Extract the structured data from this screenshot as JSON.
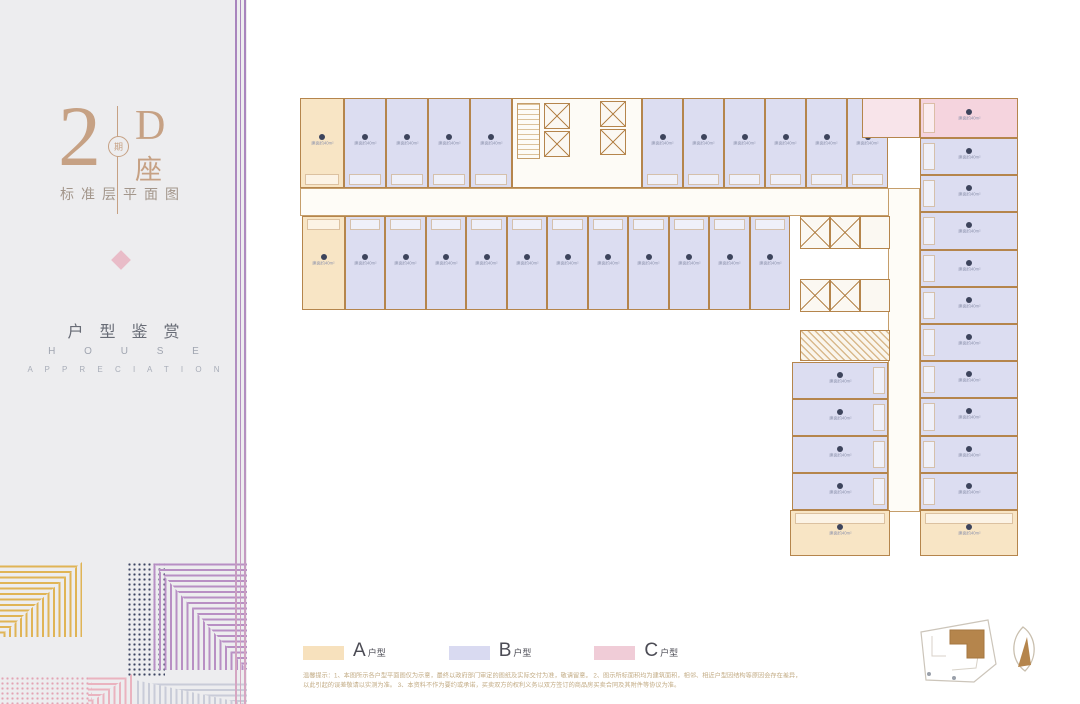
{
  "sidebar": {
    "phase_number": "2",
    "phase_char": "期",
    "block_letter": "D",
    "block_suffix": "座",
    "subtitle": "标准层平面图",
    "section_title": "户型鉴赏",
    "section_en_line1": "H O U S E",
    "section_en_line2": "A P P R E C I A T I O N",
    "accent_gold": "#e0b455",
    "accent_purple": "#b88fc4",
    "accent_pink": "#eab3bf",
    "accent_navy": "#3d4663"
  },
  "legend": {
    "items": [
      {
        "letter": "A",
        "suffix": "户型",
        "color": "#f7e1bd"
      },
      {
        "letter": "B",
        "suffix": "户型",
        "color": "#d9daf1"
      },
      {
        "letter": "C",
        "suffix": "户型",
        "color": "#f0ccd7"
      }
    ]
  },
  "disclaimer": {
    "line1": "温馨提示：1、本图所示各户型平面图仅为示意，最终以政府部门审定的图纸及实际交付为准，敬请留意。 2、图示所标面积均为建筑面积，相邻、相近户型因结构等原因会存在差异，",
    "line2": "以此引起的误差敬请以实测为准。 3、本资料不作为要约或承诺，买卖双方的权利义务以双方签订的商品房买卖合同及其附件等协议为准。"
  },
  "floorplan": {
    "unit_label": "建面约40m²",
    "type_colors": {
      "A": "#f8e5c5",
      "B": "#dcddf1",
      "C": "#f5d4de"
    },
    "wall_color": "#b5854c",
    "corridors": [
      {
        "x": 300,
        "y": 188,
        "w": 620,
        "h": 28
      },
      {
        "x": 888,
        "y": 188,
        "w": 32,
        "h": 324
      }
    ],
    "units": [
      {
        "x": 300,
        "y": 98,
        "w": 44,
        "h": 90,
        "t": "A",
        "s": "b"
      },
      {
        "x": 344,
        "y": 98,
        "w": 42,
        "h": 90,
        "t": "B",
        "s": "b"
      },
      {
        "x": 386,
        "y": 98,
        "w": 42,
        "h": 90,
        "t": "B",
        "s": "b"
      },
      {
        "x": 428,
        "y": 98,
        "w": 42,
        "h": 90,
        "t": "B",
        "s": "b"
      },
      {
        "x": 470,
        "y": 98,
        "w": 42,
        "h": 90,
        "t": "B",
        "s": "b"
      },
      {
        "x": 642,
        "y": 98,
        "w": 41,
        "h": 90,
        "t": "B",
        "s": "b"
      },
      {
        "x": 683,
        "y": 98,
        "w": 41,
        "h": 90,
        "t": "B",
        "s": "b"
      },
      {
        "x": 724,
        "y": 98,
        "w": 41,
        "h": 90,
        "t": "B",
        "s": "b"
      },
      {
        "x": 765,
        "y": 98,
        "w": 41,
        "h": 90,
        "t": "B",
        "s": "b"
      },
      {
        "x": 806,
        "y": 98,
        "w": 41,
        "h": 90,
        "t": "B",
        "s": "b"
      },
      {
        "x": 847,
        "y": 98,
        "w": 41,
        "h": 90,
        "t": "B",
        "s": "b"
      },
      {
        "x": 302,
        "y": 216,
        "w": 43,
        "h": 94,
        "t": "A",
        "s": "t"
      },
      {
        "x": 345,
        "y": 216,
        "w": 40,
        "h": 94,
        "t": "B",
        "s": "t"
      },
      {
        "x": 385,
        "y": 216,
        "w": 41,
        "h": 94,
        "t": "B",
        "s": "t"
      },
      {
        "x": 426,
        "y": 216,
        "w": 40,
        "h": 94,
        "t": "B",
        "s": "t"
      },
      {
        "x": 466,
        "y": 216,
        "w": 41,
        "h": 94,
        "t": "B",
        "s": "t"
      },
      {
        "x": 507,
        "y": 216,
        "w": 40,
        "h": 94,
        "t": "B",
        "s": "t"
      },
      {
        "x": 547,
        "y": 216,
        "w": 41,
        "h": 94,
        "t": "B",
        "s": "t"
      },
      {
        "x": 588,
        "y": 216,
        "w": 40,
        "h": 94,
        "t": "B",
        "s": "t"
      },
      {
        "x": 628,
        "y": 216,
        "w": 41,
        "h": 94,
        "t": "B",
        "s": "t"
      },
      {
        "x": 669,
        "y": 216,
        "w": 40,
        "h": 94,
        "t": "B",
        "s": "t"
      },
      {
        "x": 709,
        "y": 216,
        "w": 41,
        "h": 94,
        "t": "B",
        "s": "t"
      },
      {
        "x": 750,
        "y": 216,
        "w": 40,
        "h": 94,
        "t": "B",
        "s": "t"
      },
      {
        "x": 862,
        "y": 98,
        "w": 58,
        "h": 40,
        "t": "C",
        "annex": true,
        "nolabel": true
      },
      {
        "x": 920,
        "y": 98,
        "w": 98,
        "h": 40,
        "t": "C",
        "s": "l"
      },
      {
        "x": 920,
        "y": 138,
        "w": 98,
        "h": 37,
        "t": "B",
        "s": "l"
      },
      {
        "x": 920,
        "y": 175,
        "w": 98,
        "h": 37,
        "t": "B",
        "s": "l"
      },
      {
        "x": 920,
        "y": 212,
        "w": 98,
        "h": 38,
        "t": "B",
        "s": "l"
      },
      {
        "x": 920,
        "y": 250,
        "w": 98,
        "h": 37,
        "t": "B",
        "s": "l"
      },
      {
        "x": 920,
        "y": 287,
        "w": 98,
        "h": 37,
        "t": "B",
        "s": "l"
      },
      {
        "x": 920,
        "y": 324,
        "w": 98,
        "h": 37,
        "t": "B",
        "s": "l"
      },
      {
        "x": 920,
        "y": 361,
        "w": 98,
        "h": 37,
        "t": "B",
        "s": "l"
      },
      {
        "x": 920,
        "y": 398,
        "w": 98,
        "h": 38,
        "t": "B",
        "s": "l"
      },
      {
        "x": 920,
        "y": 436,
        "w": 98,
        "h": 37,
        "t": "B",
        "s": "l"
      },
      {
        "x": 920,
        "y": 473,
        "w": 98,
        "h": 37,
        "t": "B",
        "s": "l"
      },
      {
        "x": 792,
        "y": 362,
        "w": 96,
        "h": 37,
        "t": "B",
        "s": "r"
      },
      {
        "x": 792,
        "y": 399,
        "w": 96,
        "h": 37,
        "t": "B",
        "s": "r"
      },
      {
        "x": 792,
        "y": 436,
        "w": 96,
        "h": 37,
        "t": "B",
        "s": "r"
      },
      {
        "x": 792,
        "y": 473,
        "w": 96,
        "h": 37,
        "t": "B",
        "s": "r"
      },
      {
        "x": 790,
        "y": 510,
        "w": 100,
        "h": 46,
        "t": "A",
        "s": "t"
      },
      {
        "x": 920,
        "y": 510,
        "w": 98,
        "h": 46,
        "t": "A",
        "s": "t"
      }
    ],
    "core": {
      "x": 512,
      "y": 98,
      "w": 130,
      "h": 90
    },
    "core_stair": {
      "x": 517,
      "y": 103,
      "w": 23,
      "h": 56
    },
    "lifts": [
      {
        "x": 544,
        "y": 103,
        "w": 26,
        "h": 26
      },
      {
        "x": 544,
        "y": 131,
        "w": 26,
        "h": 26
      },
      {
        "x": 600,
        "y": 101,
        "w": 26,
        "h": 26
      },
      {
        "x": 600,
        "y": 129,
        "w": 26,
        "h": 26
      }
    ],
    "lift_banks": [
      {
        "x": 800,
        "y": 216,
        "w": 90,
        "h": 33,
        "cells": [
          "x",
          "x",
          "plain"
        ]
      },
      {
        "x": 800,
        "y": 279,
        "w": 90,
        "h": 33,
        "cells": [
          "x",
          "x",
          "plain"
        ]
      }
    ],
    "machine_room": {
      "x": 800,
      "y": 330,
      "w": 90,
      "h": 31
    }
  }
}
